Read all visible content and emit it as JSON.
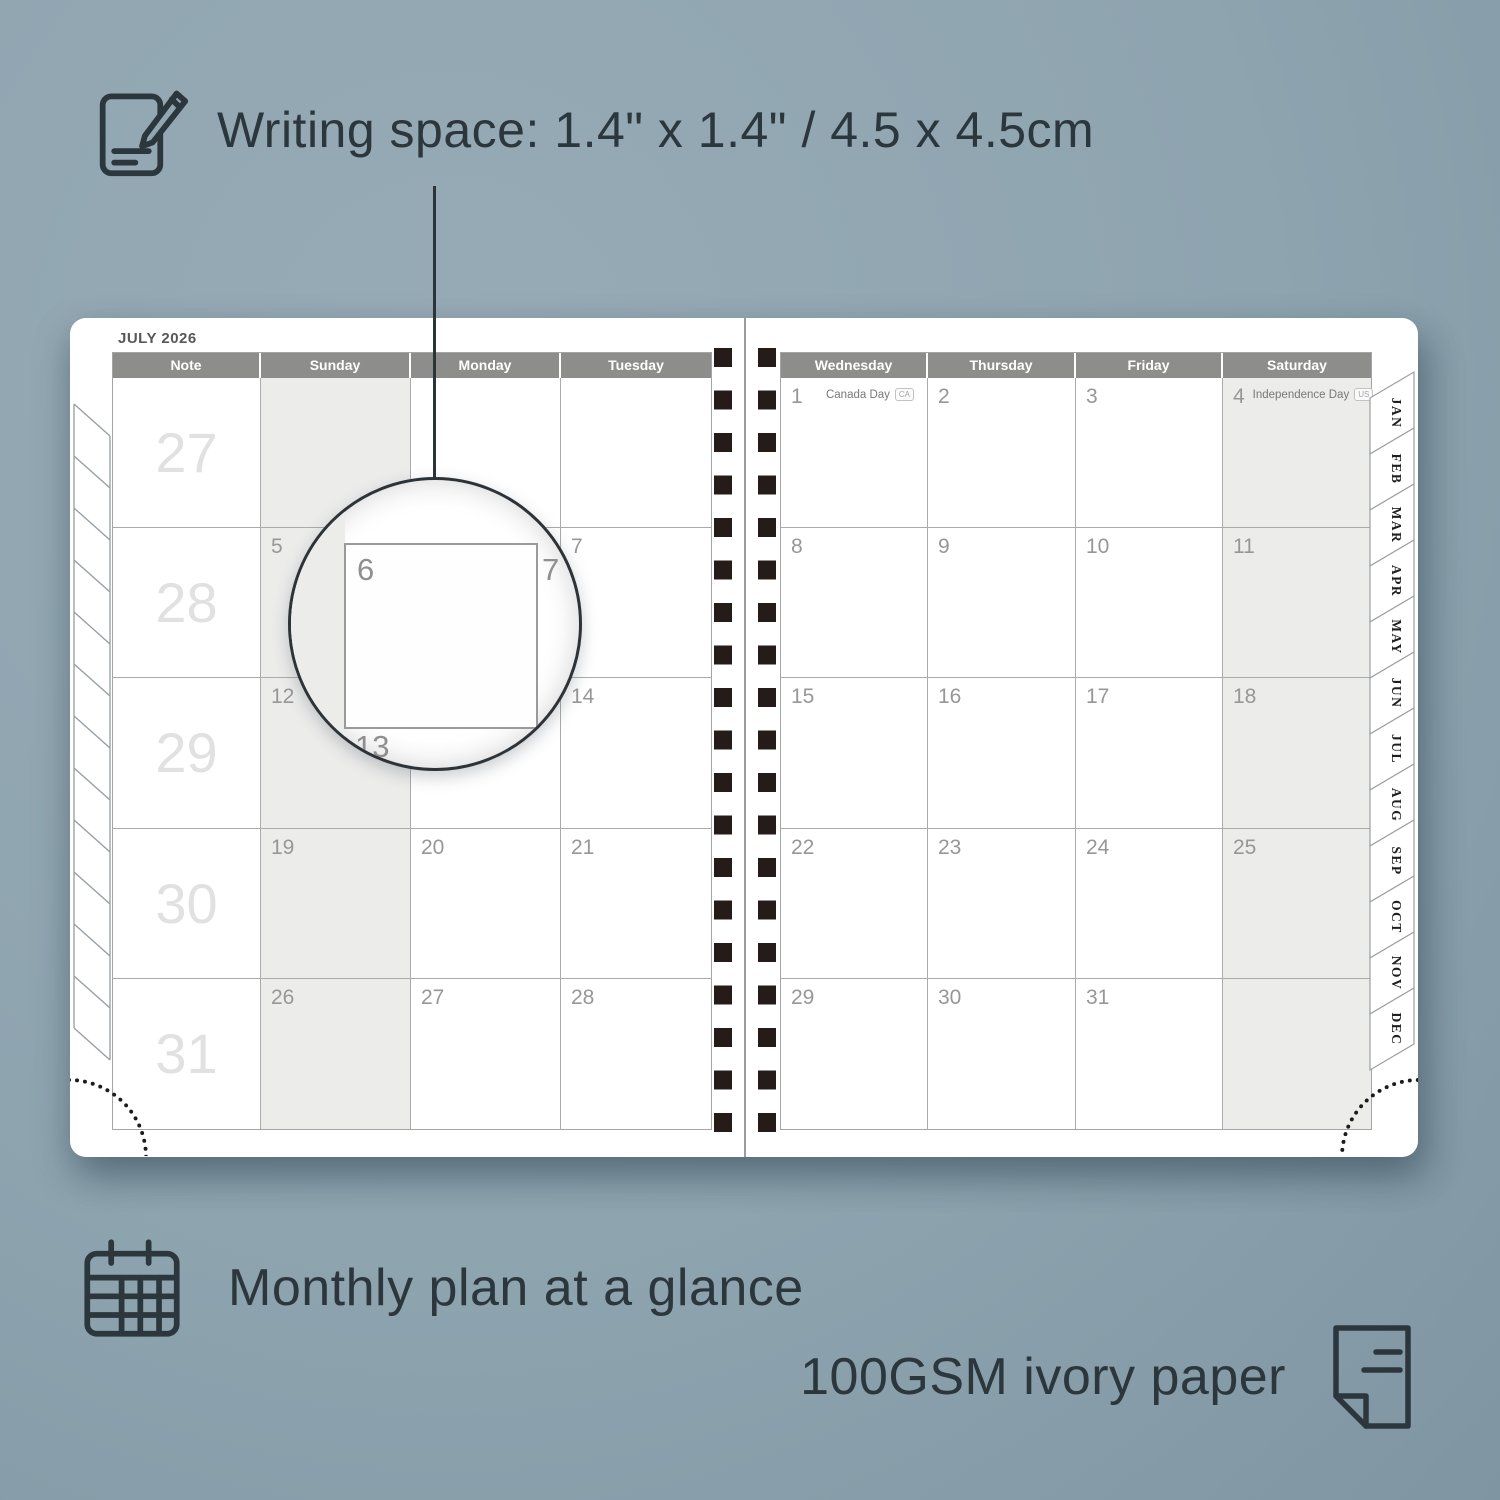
{
  "colors": {
    "background": "#91a6b1",
    "page": "#ffffff",
    "header_bar": "#8d8d8b",
    "weekend_shade": "#ececeb",
    "grid_line": "#ababab",
    "binding": "#251c19",
    "annotation_text": "#2c373d",
    "date_number": "#979797",
    "week_number": "#e1e1e1"
  },
  "annotations": {
    "writing_space": "Writing space: 1.4\" x 1.4\" / 4.5 x 4.5cm",
    "monthly_plan": "Monthly plan at a glance",
    "paper": "100GSM ivory paper"
  },
  "planner": {
    "title": "JULY 2026",
    "left_headers": [
      "Note",
      "Sunday",
      "Monday",
      "Tuesday"
    ],
    "right_headers": [
      "Wednesday",
      "Thursday",
      "Friday",
      "Saturday"
    ],
    "week_numbers": [
      "27",
      "28",
      "29",
      "30",
      "31"
    ],
    "left_rows": [
      [
        "",
        "",
        ""
      ],
      [
        "5",
        "6",
        "7"
      ],
      [
        "12",
        "13",
        "14"
      ],
      [
        "19",
        "20",
        "21"
      ],
      [
        "26",
        "27",
        "28"
      ]
    ],
    "right_rows": [
      [
        "1",
        "2",
        "3",
        "4"
      ],
      [
        "8",
        "9",
        "10",
        "11"
      ],
      [
        "15",
        "16",
        "17",
        "18"
      ],
      [
        "22",
        "23",
        "24",
        "25"
      ],
      [
        "29",
        "30",
        "31",
        ""
      ]
    ],
    "holidays": [
      {
        "label": "Canada Day",
        "badge": "CA"
      },
      {
        "label": "Independence Day",
        "badge": "US"
      }
    ],
    "tabs": [
      "JAN",
      "FEB",
      "MAR",
      "APR",
      "MAY",
      "JUN",
      "JUL",
      "AUG",
      "SEP",
      "OCT",
      "NOV",
      "DEC"
    ],
    "magnifier": {
      "day": "6",
      "right_day": "7",
      "below_day": "13"
    }
  }
}
